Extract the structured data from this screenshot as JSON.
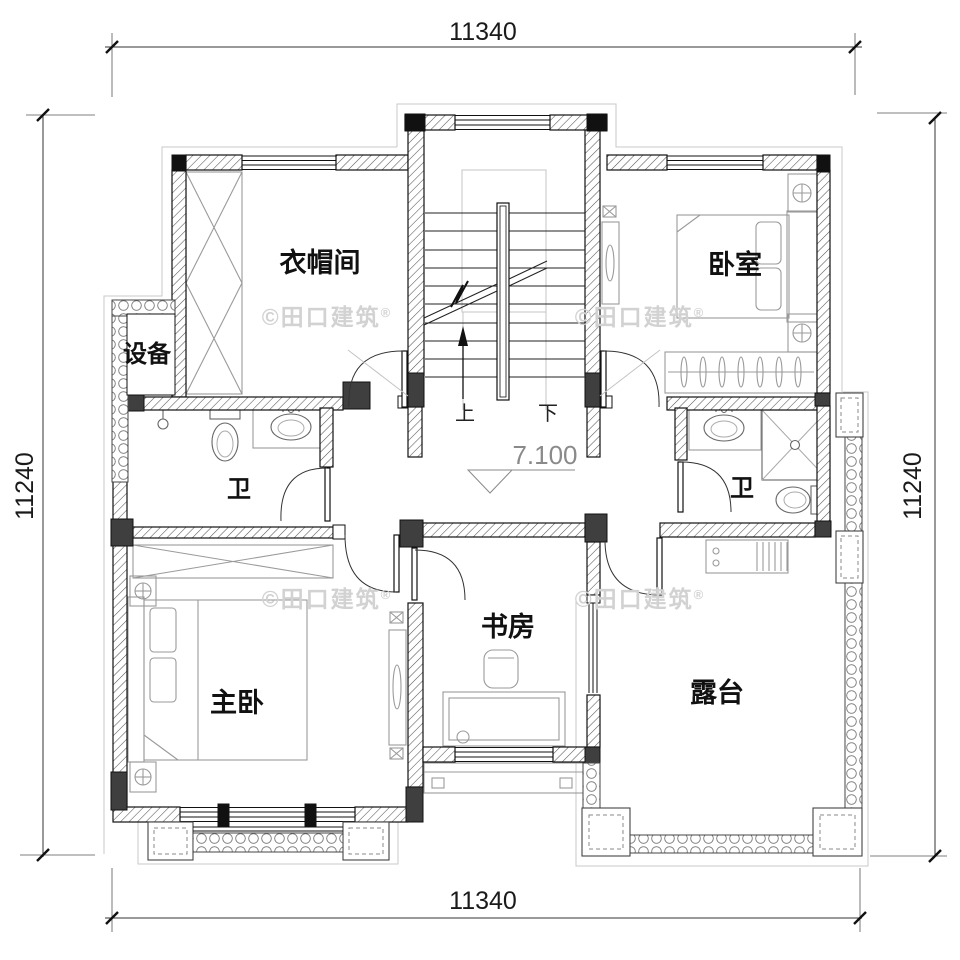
{
  "meta": {
    "drawing_type": "residential floor plan"
  },
  "dimensions": {
    "top": "11340",
    "bottom": "11340",
    "left": "11240",
    "right": "11240"
  },
  "rooms": [
    {
      "key": "cloakroom",
      "label": "衣帽间"
    },
    {
      "key": "bedroom",
      "label": "卧室"
    },
    {
      "key": "equipment",
      "label": "设备"
    },
    {
      "key": "bath-left",
      "label": "卫"
    },
    {
      "key": "bath-right",
      "label": "卫"
    },
    {
      "key": "master-bedroom",
      "label": "主卧"
    },
    {
      "key": "study",
      "label": "书房"
    },
    {
      "key": "terrace",
      "label": "露台"
    }
  ],
  "stairs": {
    "up_label": "上",
    "down_label": "下"
  },
  "elevation": {
    "value": "7.100"
  },
  "watermark": {
    "text": "©田口建筑",
    "registered": "®"
  }
}
